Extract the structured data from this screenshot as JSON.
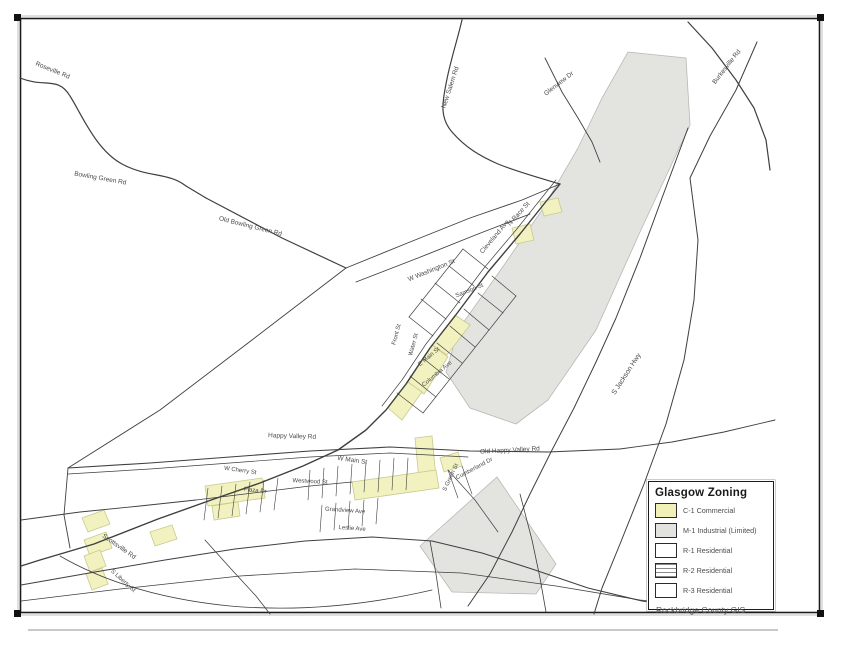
{
  "legend": {
    "title": "Glasgow Zoning",
    "items": [
      {
        "label": "C-1 Commercial",
        "fill": "#f0f0b8",
        "pattern": "solid"
      },
      {
        "label": "M-1 Industrial (Limited)",
        "fill": "#e2e2df",
        "pattern": "solid"
      },
      {
        "label": "R-1 Residential",
        "fill": "#ffffff",
        "pattern": "solid"
      },
      {
        "label": "R-2 Residential",
        "fill": "#ffffff",
        "pattern": "hlines"
      },
      {
        "label": "R-3 Residential",
        "fill": "#ffffff",
        "pattern": "solid"
      }
    ]
  },
  "attribution": "Rockbridge County GIS",
  "colors": {
    "road": "#3f3f3f",
    "label": "#4a4a4a",
    "commercial": "#f2f2c0",
    "commercial_edge": "#c9c98f",
    "industrial": "#e3e3e0",
    "industrial_edge": "#b9b9b3",
    "border": "#1c1c1c"
  },
  "map": {
    "zones": [
      {
        "name": "industrial-zone-north",
        "d": "M628,52 L686,58 L690,125 L640,232 L596,330 L548,400 L516,424 L470,408 L446,372 L458,330 L502,268 L542,210 L578,148 L602,98 Z",
        "type": "industrial"
      },
      {
        "name": "industrial-zone-south",
        "d": "M497,477 L556,564 L536,594 L452,592 L420,546 Z",
        "type": "industrial"
      },
      {
        "name": "commercial-strip-1",
        "d": "M432,345 L455,315 L470,325 L447,355 Z",
        "type": "commercial"
      },
      {
        "name": "commercial-strip-2",
        "d": "M408,382 L432,345 L448,357 L424,394 Z",
        "type": "commercial"
      },
      {
        "name": "commercial-strip-3",
        "d": "M388,408 L408,382 L422,392 L402,420 Z",
        "type": "commercial"
      },
      {
        "name": "commercial-patch-4",
        "d": "M512,228 L530,224 L534,240 L516,244 Z",
        "type": "commercial"
      },
      {
        "name": "commercial-patch-5",
        "d": "M540,202 L558,198 L562,212 L544,216 Z",
        "type": "commercial"
      },
      {
        "name": "commercial-strip-6",
        "d": "M415,438 L432,436 L436,478 L419,480 Z",
        "type": "commercial"
      },
      {
        "name": "commercial-strip-7",
        "d": "M352,482 L436,470 L439,488 L355,500 Z",
        "type": "commercial"
      },
      {
        "name": "commercial-cluster-8",
        "d": "M205,486 L262,478 L265,498 L208,506 Z",
        "type": "commercial"
      },
      {
        "name": "commercial-cluster-9",
        "d": "M212,506 L238,502 L240,516 L214,520 Z",
        "type": "commercial"
      },
      {
        "name": "commercial-strip-10",
        "d": "M82,518 L104,510 L110,524 L88,532 Z",
        "type": "commercial"
      },
      {
        "name": "commercial-strip-11",
        "d": "M84,540 L106,532 L112,548 L90,556 Z",
        "type": "commercial"
      },
      {
        "name": "commercial-strip-12",
        "d": "M150,532 L172,525 L177,539 L155,546 Z",
        "type": "commercial"
      },
      {
        "name": "commercial-strip-13",
        "d": "M84,556 L100,550 L106,566 L90,572 Z",
        "type": "commercial"
      },
      {
        "name": "commercial-strip-14",
        "d": "M86,574 L102,568 L108,584 L92,590 Z",
        "type": "commercial"
      },
      {
        "name": "commercial-patch-15",
        "d": "M440,458 L458,452 L462,466 L444,472 Z",
        "type": "commercial"
      }
    ],
    "roads": [
      {
        "d": "M20,78 C45,88 58,76 70,96 C82,115 96,150 122,164 C148,178 168,172 186,186 L206,198",
        "w": 1.2
      },
      {
        "d": "M206,198 L282,238 L346,268",
        "w": 1.2
      },
      {
        "d": "M346,268 L252,340 L160,410 L68,468",
        "w": 0.9
      },
      {
        "d": "M346,268 L410,242 L470,218 L522,200 L560,184",
        "w": 0.9
      },
      {
        "d": "M356,282 L418,258 L478,234 L530,214",
        "w": 0.9
      },
      {
        "d": "M462,20 C456,45 450,62 446,84 C442,104 440,118 452,132 C466,148 480,156 498,164 C518,172 540,178 560,184",
        "w": 1.2
      },
      {
        "d": "M545,58 L562,92 L578,118 L592,142 L600,162",
        "w": 0.9
      },
      {
        "d": "M688,22 L712,48 L736,80 L754,108 L766,140 L770,170",
        "w": 1.2
      },
      {
        "d": "M757,42 L736,90 L710,136 L690,178 L698,240 L694,300 L684,360 L666,424 L644,484 L620,544 L602,588 L594,614",
        "w": 1.0
      },
      {
        "d": "M688,128 L662,198 L640,258 L616,318 L596,362 L574,408 L552,450 L530,494 L512,532 L490,574 L468,606",
        "w": 1.0
      },
      {
        "d": "M560,184 L520,234 L488,272 L455,316 L430,348 L406,384 L386,410 L366,430 L338,450 L303,466 L260,483 L214,499 L158,519 L94,544 L40,560 L21,566",
        "w": 1.4
      },
      {
        "d": "M556,180 L516,230 L484,268 L451,312 L426,344 L402,380 L382,406",
        "w": 0.7
      },
      {
        "d": "M68,468 L150,463 L230,457 L310,451 L390,447 L470,451 L548,452 L620,449",
        "w": 1.1
      },
      {
        "d": "M68,474 L150,469 L230,463 L310,457 L390,453 L468,457",
        "w": 0.7
      },
      {
        "d": "M620,449 L672,442 L724,432 L775,420",
        "w": 0.9
      },
      {
        "d": "M68,468 L64,515 L70,548",
        "w": 0.9
      },
      {
        "d": "M21,520 L80,512 L140,506 L196,500",
        "w": 0.9
      },
      {
        "d": "M21,585 L95,572 L165,560 L235,549 L305,541 L372,537 L432,541 L482,553 L532,569 L588,588 L642,601 L706,610",
        "w": 1.0
      },
      {
        "d": "M21,601 L120,589 L240,576 L355,569 L462,573 L556,586 L640,600 L722,608",
        "w": 0.8
      },
      {
        "d": "M60,556 C110,585 170,600 230,606 C310,613 380,602 432,590",
        "w": 0.8
      },
      {
        "d": "M205,540 L232,570 L256,596 L270,614",
        "w": 0.8
      },
      {
        "d": "M430,541 L436,574 L441,608",
        "w": 0.8
      },
      {
        "d": "M520,494 L532,540 L540,578 L546,612",
        "w": 0.8
      },
      {
        "d": "M492,276 L516,296",
        "w": 0.7
      },
      {
        "d": "M478,293 L503,313",
        "w": 0.7
      },
      {
        "d": "M464,309 L489,330",
        "w": 0.7
      },
      {
        "d": "M450,326 L475,347",
        "w": 0.7
      },
      {
        "d": "M437,343 L462,363",
        "w": 0.7
      },
      {
        "d": "M424,359 L449,379",
        "w": 0.7
      },
      {
        "d": "M410,376 L436,397",
        "w": 0.7
      },
      {
        "d": "M397,393 L423,413",
        "w": 0.7
      },
      {
        "d": "M516,296 L423,413",
        "w": 0.7
      },
      {
        "d": "M488,269 L463,249",
        "w": 0.7
      },
      {
        "d": "M474,286 L449,266",
        "w": 0.7
      },
      {
        "d": "M460,303 L435,283",
        "w": 0.7
      },
      {
        "d": "M446,319 L421,299",
        "w": 0.7
      },
      {
        "d": "M433,336 L409,317",
        "w": 0.7
      },
      {
        "d": "M463,249 L409,317",
        "w": 0.7
      },
      {
        "d": "M310,470 L308,500",
        "w": 0.6
      },
      {
        "d": "M324,468 L322,498",
        "w": 0.6
      },
      {
        "d": "M338,466 L336,496",
        "w": 0.6
      },
      {
        "d": "M352,464 L350,494",
        "w": 0.6
      },
      {
        "d": "M366,462 L364,492",
        "w": 0.6
      },
      {
        "d": "M380,460 L378,492",
        "w": 0.6
      },
      {
        "d": "M394,458 L392,490",
        "w": 0.6
      },
      {
        "d": "M408,458 L406,490",
        "w": 0.6
      },
      {
        "d": "M448,470 L458,498",
        "w": 0.6
      },
      {
        "d": "M462,466 L472,494",
        "w": 0.6
      },
      {
        "d": "M208,488 L204,520",
        "w": 0.6
      },
      {
        "d": "M222,486 L218,518",
        "w": 0.6
      },
      {
        "d": "M236,484 L232,516",
        "w": 0.6
      },
      {
        "d": "M250,482 L246,514",
        "w": 0.6
      },
      {
        "d": "M264,480 L260,512",
        "w": 0.6
      },
      {
        "d": "M278,478 L274,510",
        "w": 0.6
      },
      {
        "d": "M322,505 L320,532",
        "w": 0.6
      },
      {
        "d": "M336,503 L334,530",
        "w": 0.6
      },
      {
        "d": "M350,501 L348,528",
        "w": 0.6
      },
      {
        "d": "M364,500 L362,526",
        "w": 0.6
      },
      {
        "d": "M378,498 L376,524",
        "w": 0.6
      },
      {
        "d": "M196,500 L310,486 L352,482",
        "w": 0.8
      },
      {
        "d": "M448,470 L475,500 L498,532",
        "w": 0.7
      }
    ],
    "labels": [
      {
        "x": 52,
        "y": 72,
        "r": 22,
        "t": "Roseville Rd",
        "s": 6.5
      },
      {
        "x": 100,
        "y": 180,
        "r": 10,
        "t": "Bowling Green Rd",
        "s": 6.5
      },
      {
        "x": 250,
        "y": 228,
        "r": 14,
        "t": "Old Bowling Green Rd",
        "s": 6.5
      },
      {
        "x": 452,
        "y": 88,
        "r": -72,
        "t": "New Salem Rd",
        "s": 6.5
      },
      {
        "x": 560,
        "y": 85,
        "r": -38,
        "t": "Glenview Dr",
        "s": 6.5
      },
      {
        "x": 728,
        "y": 68,
        "r": -52,
        "t": "Burkesville Rd",
        "s": 6.5
      },
      {
        "x": 520,
        "y": 215,
        "r": -48,
        "t": "N Race St",
        "s": 6.5
      },
      {
        "x": 432,
        "y": 272,
        "r": -22,
        "t": "W Washington St",
        "s": 6.5
      },
      {
        "x": 470,
        "y": 292,
        "r": -22,
        "t": "Samson St",
        "s": 6
      },
      {
        "x": 496,
        "y": 238,
        "r": -50,
        "t": "Cleveland Ave",
        "s": 6.5
      },
      {
        "x": 628,
        "y": 375,
        "r": -57,
        "t": "S Jackson Hwy",
        "s": 7
      },
      {
        "x": 398,
        "y": 335,
        "r": -75,
        "t": "Front St",
        "s": 6
      },
      {
        "x": 415,
        "y": 345,
        "r": -75,
        "t": "Water St",
        "s": 6
      },
      {
        "x": 430,
        "y": 358,
        "r": -40,
        "t": "E Main St",
        "s": 6
      },
      {
        "x": 438,
        "y": 375,
        "r": -40,
        "t": "Columbia Ave",
        "s": 6
      },
      {
        "x": 292,
        "y": 438,
        "r": 2,
        "t": "Happy Valley Rd",
        "s": 6.5
      },
      {
        "x": 510,
        "y": 452,
        "r": -3,
        "t": "Old Happy Valley Rd",
        "s": 6.5
      },
      {
        "x": 352,
        "y": 462,
        "r": 8,
        "t": "W Main St",
        "s": 6.5
      },
      {
        "x": 240,
        "y": 472,
        "r": 8,
        "t": "W Cherry St",
        "s": 6
      },
      {
        "x": 255,
        "y": 492,
        "r": 6,
        "t": "Plaza Dr",
        "s": 6
      },
      {
        "x": 452,
        "y": 478,
        "r": -65,
        "t": "S Green St",
        "s": 6
      },
      {
        "x": 345,
        "y": 512,
        "r": 4,
        "t": "Grandview Ave",
        "s": 6
      },
      {
        "x": 352,
        "y": 530,
        "r": 4,
        "t": "Leslie Ave",
        "s": 6
      },
      {
        "x": 118,
        "y": 548,
        "r": 35,
        "t": "Scottsville Rd",
        "s": 6.5
      },
      {
        "x": 122,
        "y": 582,
        "r": 42,
        "t": "S Liberty St",
        "s": 6
      },
      {
        "x": 310,
        "y": 483,
        "r": 3,
        "t": "Westwood St",
        "s": 6
      },
      {
        "x": 475,
        "y": 470,
        "r": -28,
        "t": "Cumberland Dr",
        "s": 6
      }
    ],
    "corner_marks": [
      {
        "x": 14,
        "y": 14
      },
      {
        "x": 817,
        "y": 14
      },
      {
        "x": 14,
        "y": 610
      },
      {
        "x": 817,
        "y": 610
      }
    ],
    "border": {
      "x": 20.5,
      "y": 18.5,
      "w": 799,
      "h": 594
    }
  }
}
